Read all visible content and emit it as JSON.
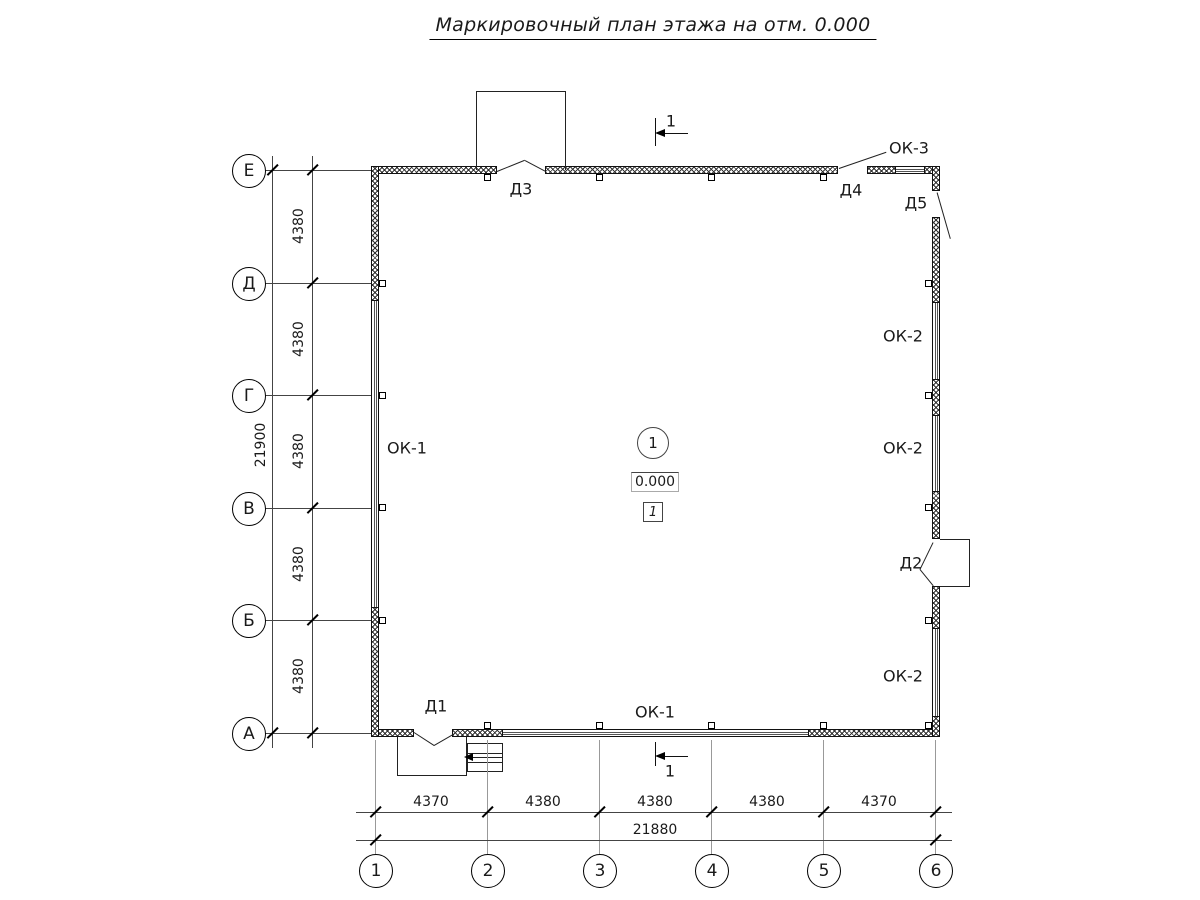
{
  "title": "Маркировочный план этажа на отм. 0.000",
  "grid": {
    "rows": [
      "Е",
      "Д",
      "Г",
      "В",
      "Б",
      "А"
    ],
    "cols": [
      "1",
      "2",
      "3",
      "4",
      "5",
      "6"
    ]
  },
  "dims": {
    "left_segments": [
      "4380",
      "4380",
      "4380",
      "4380",
      "4380"
    ],
    "left_total": "21900",
    "bottom_segments": [
      "4370",
      "4380",
      "4380",
      "4380",
      "4370"
    ],
    "bottom_total": "21880"
  },
  "doors": {
    "d1": "Д1",
    "d2": "Д2",
    "d3": "Д3",
    "d4": "Д4",
    "d5": "Д5"
  },
  "windows": {
    "left": "ОК-1",
    "bottom": "ОК-1",
    "right_upper": "ОК-2",
    "right_middle": "ОК-2",
    "right_lower": "ОК-2",
    "top": "ОК-3"
  },
  "room": {
    "zone_number": "1",
    "elevation": "0.000",
    "room_number": "1"
  },
  "section": {
    "top_label": "1",
    "bottom_label": "1"
  }
}
